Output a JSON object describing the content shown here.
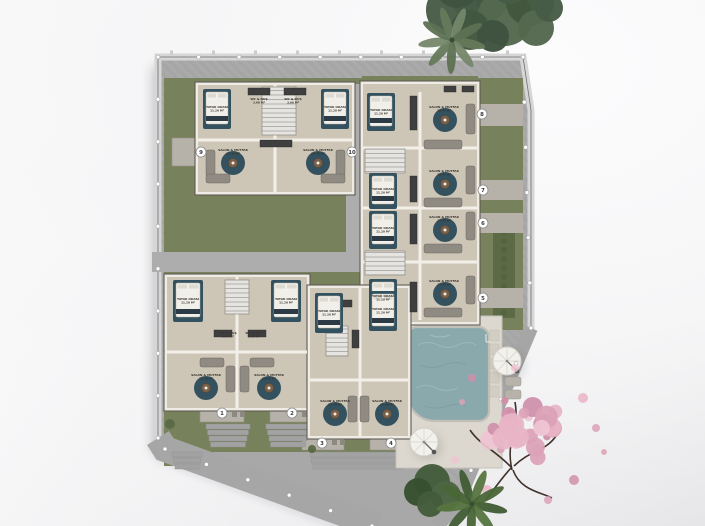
{
  "site": {
    "title": "residential-site-plan",
    "colors": {
      "lawn": "#77815b",
      "lawn_dark": "#5c6b46",
      "walkway": "#a8a8a8",
      "wall_band": "#d6d6d6",
      "pad": "#b6b2aa",
      "building_wall": "#efece6",
      "floor": "#cdc5b6",
      "rug_teal": "#33515e",
      "sofa_gray": "#8f8a82",
      "wood": "#7a5f46",
      "pool_water": "#8aa9ad",
      "pool_deck": "#dcd8cf",
      "blossom_pink": "#dba2b6",
      "tree_green": "#47603f",
      "badge_fill": "#ffffff",
      "badge_text": "#3a3a3a",
      "label_text": "#3a362e"
    },
    "units": [
      {
        "number": "1",
        "x": 222,
        "y": 413
      },
      {
        "number": "2",
        "x": 292,
        "y": 413
      },
      {
        "number": "3",
        "x": 322,
        "y": 443
      },
      {
        "number": "4",
        "x": 391,
        "y": 443
      },
      {
        "number": "5",
        "x": 483,
        "y": 298
      },
      {
        "number": "6",
        "x": 483,
        "y": 223
      },
      {
        "number": "7",
        "x": 483,
        "y": 190
      },
      {
        "number": "8",
        "x": 482,
        "y": 114
      },
      {
        "number": "9",
        "x": 201,
        "y": 152
      },
      {
        "number": "10",
        "x": 352,
        "y": 152
      }
    ],
    "rooms": {
      "types": {
        "bedroom": {
          "label": "YATAK ODASI",
          "area": "11.20 M²"
        },
        "living": {
          "label": "SALON & MUTFAK",
          "area": "23.40 M²"
        },
        "bath": {
          "label": "WC & DUŞ",
          "area": "3.60 M²"
        }
      },
      "instances": [
        {
          "type": "bedroom",
          "x": 217,
          "y": 108
        },
        {
          "type": "bedroom",
          "x": 335,
          "y": 108
        },
        {
          "type": "bedroom",
          "x": 381,
          "y": 111
        },
        {
          "type": "bedroom",
          "x": 383,
          "y": 190
        },
        {
          "type": "bedroom",
          "x": 383,
          "y": 229
        },
        {
          "type": "bedroom",
          "x": 383,
          "y": 297
        },
        {
          "type": "bedroom",
          "x": 188,
          "y": 300
        },
        {
          "type": "bedroom",
          "x": 286,
          "y": 300
        },
        {
          "type": "bedroom",
          "x": 329,
          "y": 312
        },
        {
          "type": "bedroom",
          "x": 383,
          "y": 310
        },
        {
          "type": "living",
          "x": 233,
          "y": 151
        },
        {
          "type": "living",
          "x": 318,
          "y": 151
        },
        {
          "type": "living",
          "x": 444,
          "y": 108
        },
        {
          "type": "living",
          "x": 444,
          "y": 172
        },
        {
          "type": "living",
          "x": 444,
          "y": 218
        },
        {
          "type": "living",
          "x": 444,
          "y": 282
        },
        {
          "type": "living",
          "x": 206,
          "y": 376
        },
        {
          "type": "living",
          "x": 269,
          "y": 376
        },
        {
          "type": "living",
          "x": 335,
          "y": 402
        },
        {
          "type": "living",
          "x": 387,
          "y": 402
        },
        {
          "type": "bath",
          "x": 259,
          "y": 100
        },
        {
          "type": "bath",
          "x": 293,
          "y": 100
        },
        {
          "type": "bath",
          "x": 228,
          "y": 334
        },
        {
          "type": "bath",
          "x": 254,
          "y": 334
        }
      ]
    }
  }
}
